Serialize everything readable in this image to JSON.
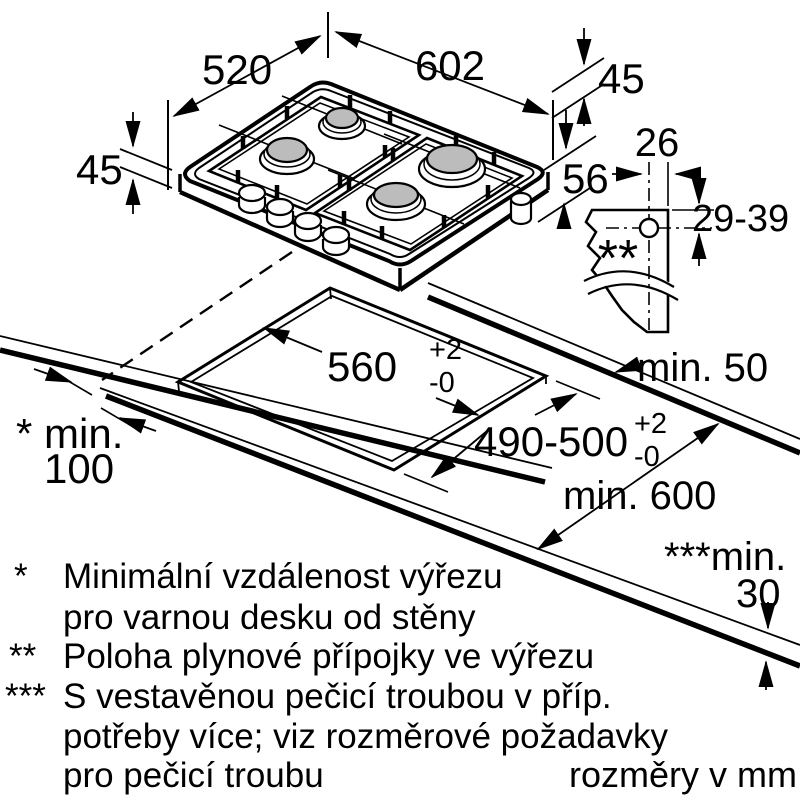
{
  "diagram": {
    "hob": {
      "width": "602",
      "depth": "520",
      "rim_height_left": "45",
      "rim_height_right": "45",
      "body_depth": "56"
    },
    "gas_connection": {
      "offset": "26",
      "height_range": "29-39",
      "marker": "**"
    },
    "cutout": {
      "width": "560",
      "width_tol_plus": "+2",
      "width_tol_minus": "-0",
      "depth": "490-500",
      "depth_tol_plus": "+2",
      "depth_tol_minus": "-0"
    },
    "clearances": {
      "right_wall": "min. 50",
      "left_wall_label": "* min.",
      "left_wall_value": "100",
      "worktop_depth": "min. 600",
      "thickness_label": "***min.",
      "thickness_value": "30"
    },
    "footnotes": {
      "f1_marker": "*",
      "f1_line1": "Minimální vzdálenost výřezu",
      "f1_line2": "pro varnou desku od stěny",
      "f2_marker": "**",
      "f2_line1": "Poloha plynové přípojky ve výřezu",
      "f3_marker": "***",
      "f3_line1": "S vestavěnou pečicí troubou v příp.",
      "f3_line2": "potřeby více; viz rozměrové požadavky",
      "f3_line3": "pro pečicí troubu"
    },
    "units_note": "rozměry v mm",
    "colors": {
      "line": "#000000",
      "burner_fill": "#bcbcbc",
      "background": "#ffffff"
    }
  }
}
